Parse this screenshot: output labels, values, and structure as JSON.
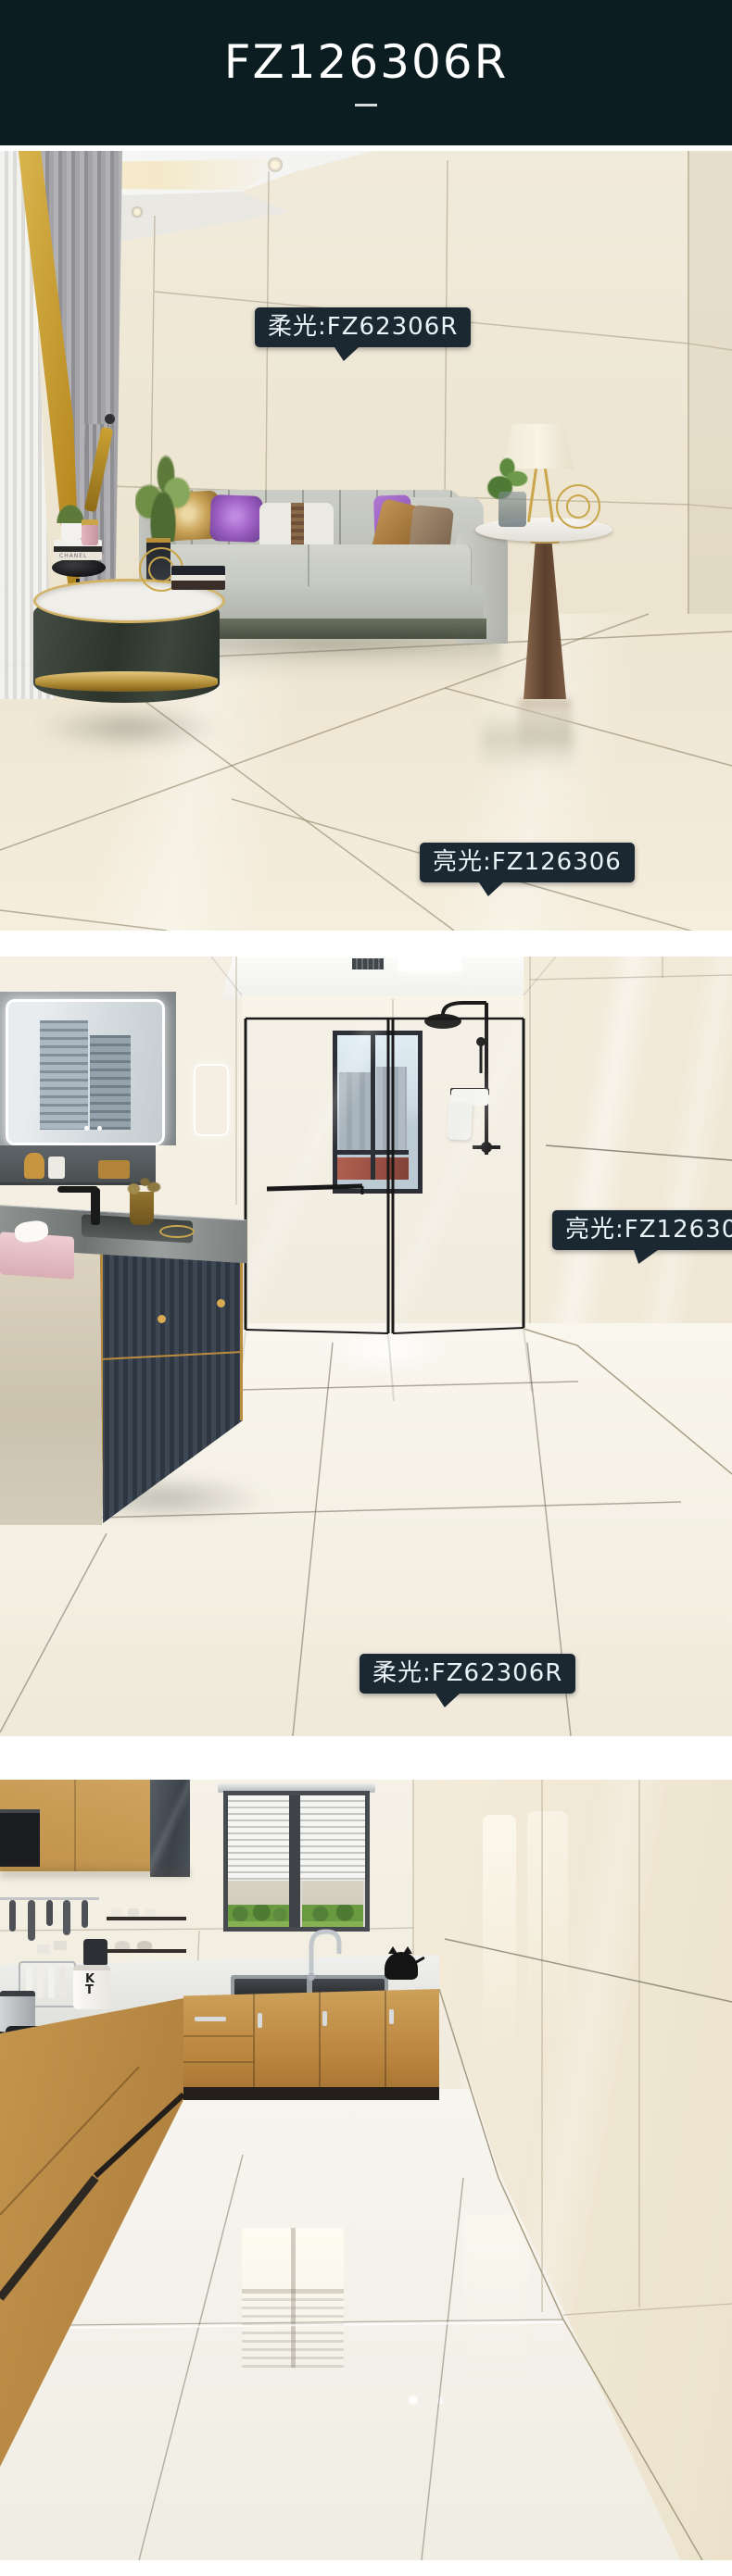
{
  "header": {
    "title": "FZ126306R"
  },
  "panels": {
    "living_room": {
      "badge_soft": "柔光:FZ62306R",
      "badge_bright": "亮光:FZ126306",
      "book_label": "CHANEL"
    },
    "bathroom": {
      "badge_bright": "亮光:FZ126306",
      "badge_soft": "柔光:FZ62306R"
    },
    "kitchen": {
      "canister_label": "KT"
    }
  },
  "colors": {
    "header_bg": "#0b1d21",
    "header_text": "#ffffff",
    "badge_bg": "#1b2731",
    "badge_text": "#e9f3f8",
    "gold_accent": "#c9a64a"
  }
}
